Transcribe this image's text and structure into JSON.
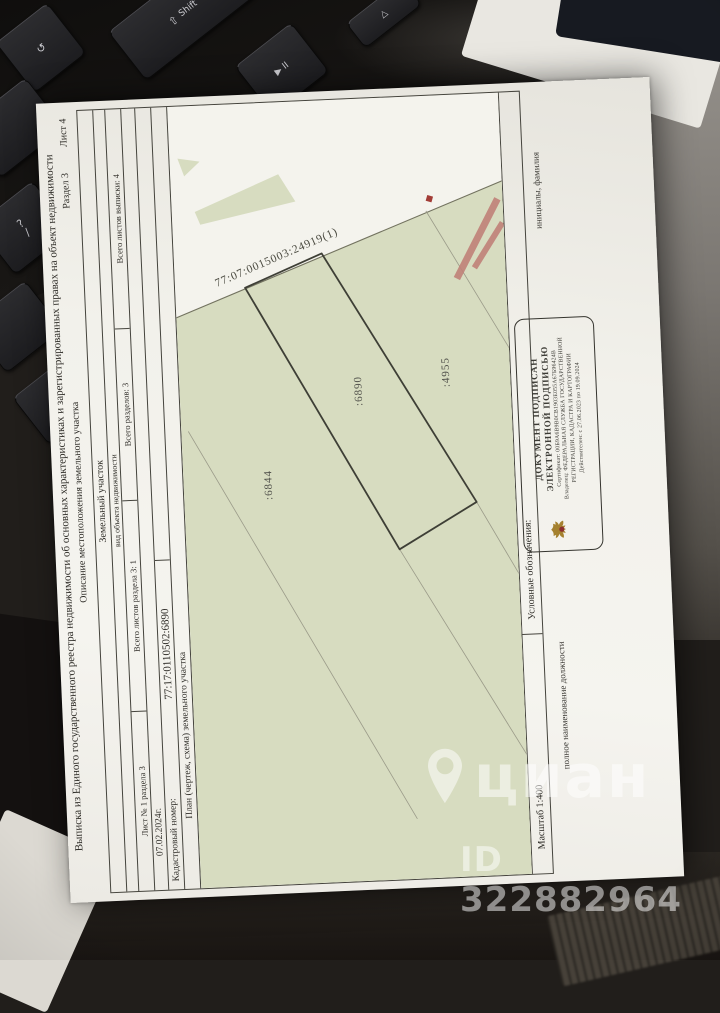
{
  "watermark": {
    "brand": "циан",
    "id": "ID 322882964"
  },
  "keyboard": {
    "shift_icon": "⇧",
    "shift": "Shift",
    "media": "▶ II",
    "up": "△",
    "undo": "↺",
    "question": "?",
    "slash": "/",
    "letter": "Э"
  },
  "document": {
    "title": "Выписка из Единого государственного реестра недвижимости об основных характеристиках и зарегистрированных правах на объект недвижимости",
    "subtitle": "Описание местоположения земельного участка",
    "section_label": "Раздел 3",
    "sheet_label": "Лист 4",
    "object_type": "Земельный участок",
    "object_type_caption": "вид объекта недвижимости",
    "sheet_info": [
      "Лист № 1 раздела 3",
      "Всего листов раздела 3: 1",
      "Всего разделов: 3",
      "Всего листов выписки: 4"
    ],
    "date": "07.02.2024г.",
    "cadastral_number_label": "Кадастровый номер:",
    "cadastral_number": "77:17:0110502:6890",
    "plan_label": "План (чертеж, схема) земельного участка",
    "scale_label": "Масштаб 1:400",
    "legend_label": "Условные обозначения:",
    "signature_position_caption": "полное наименование должности",
    "signature_name_caption": "инициалы, фамилия",
    "stamp": {
      "line1": "ДОКУМЕНТ ПОДПИСАН",
      "line2": "ЭЛЕКТРОННОЙ ПОДПИСЬЮ",
      "certificate": "Сертификат: 00Б9А6В9В0СВ1903Е055А67Б96424В",
      "owner_line1": "Владелец: ФЕДЕРАЛЬНАЯ СЛУЖБА ГОСУДАРСТВЕННОЙ",
      "owner_line2": "РЕГИСТРАЦИИ, КАДАСТРА И КАРТОГРАФИИ",
      "validity": "Действителен: с 27.06.2023 по 19.09.2024"
    },
    "plan": {
      "quarter_number": "77:07:0015003:24919(1)",
      "parcel_left": ":6844",
      "parcel_subject": ":6890",
      "parcel_right": ":4955"
    }
  }
}
